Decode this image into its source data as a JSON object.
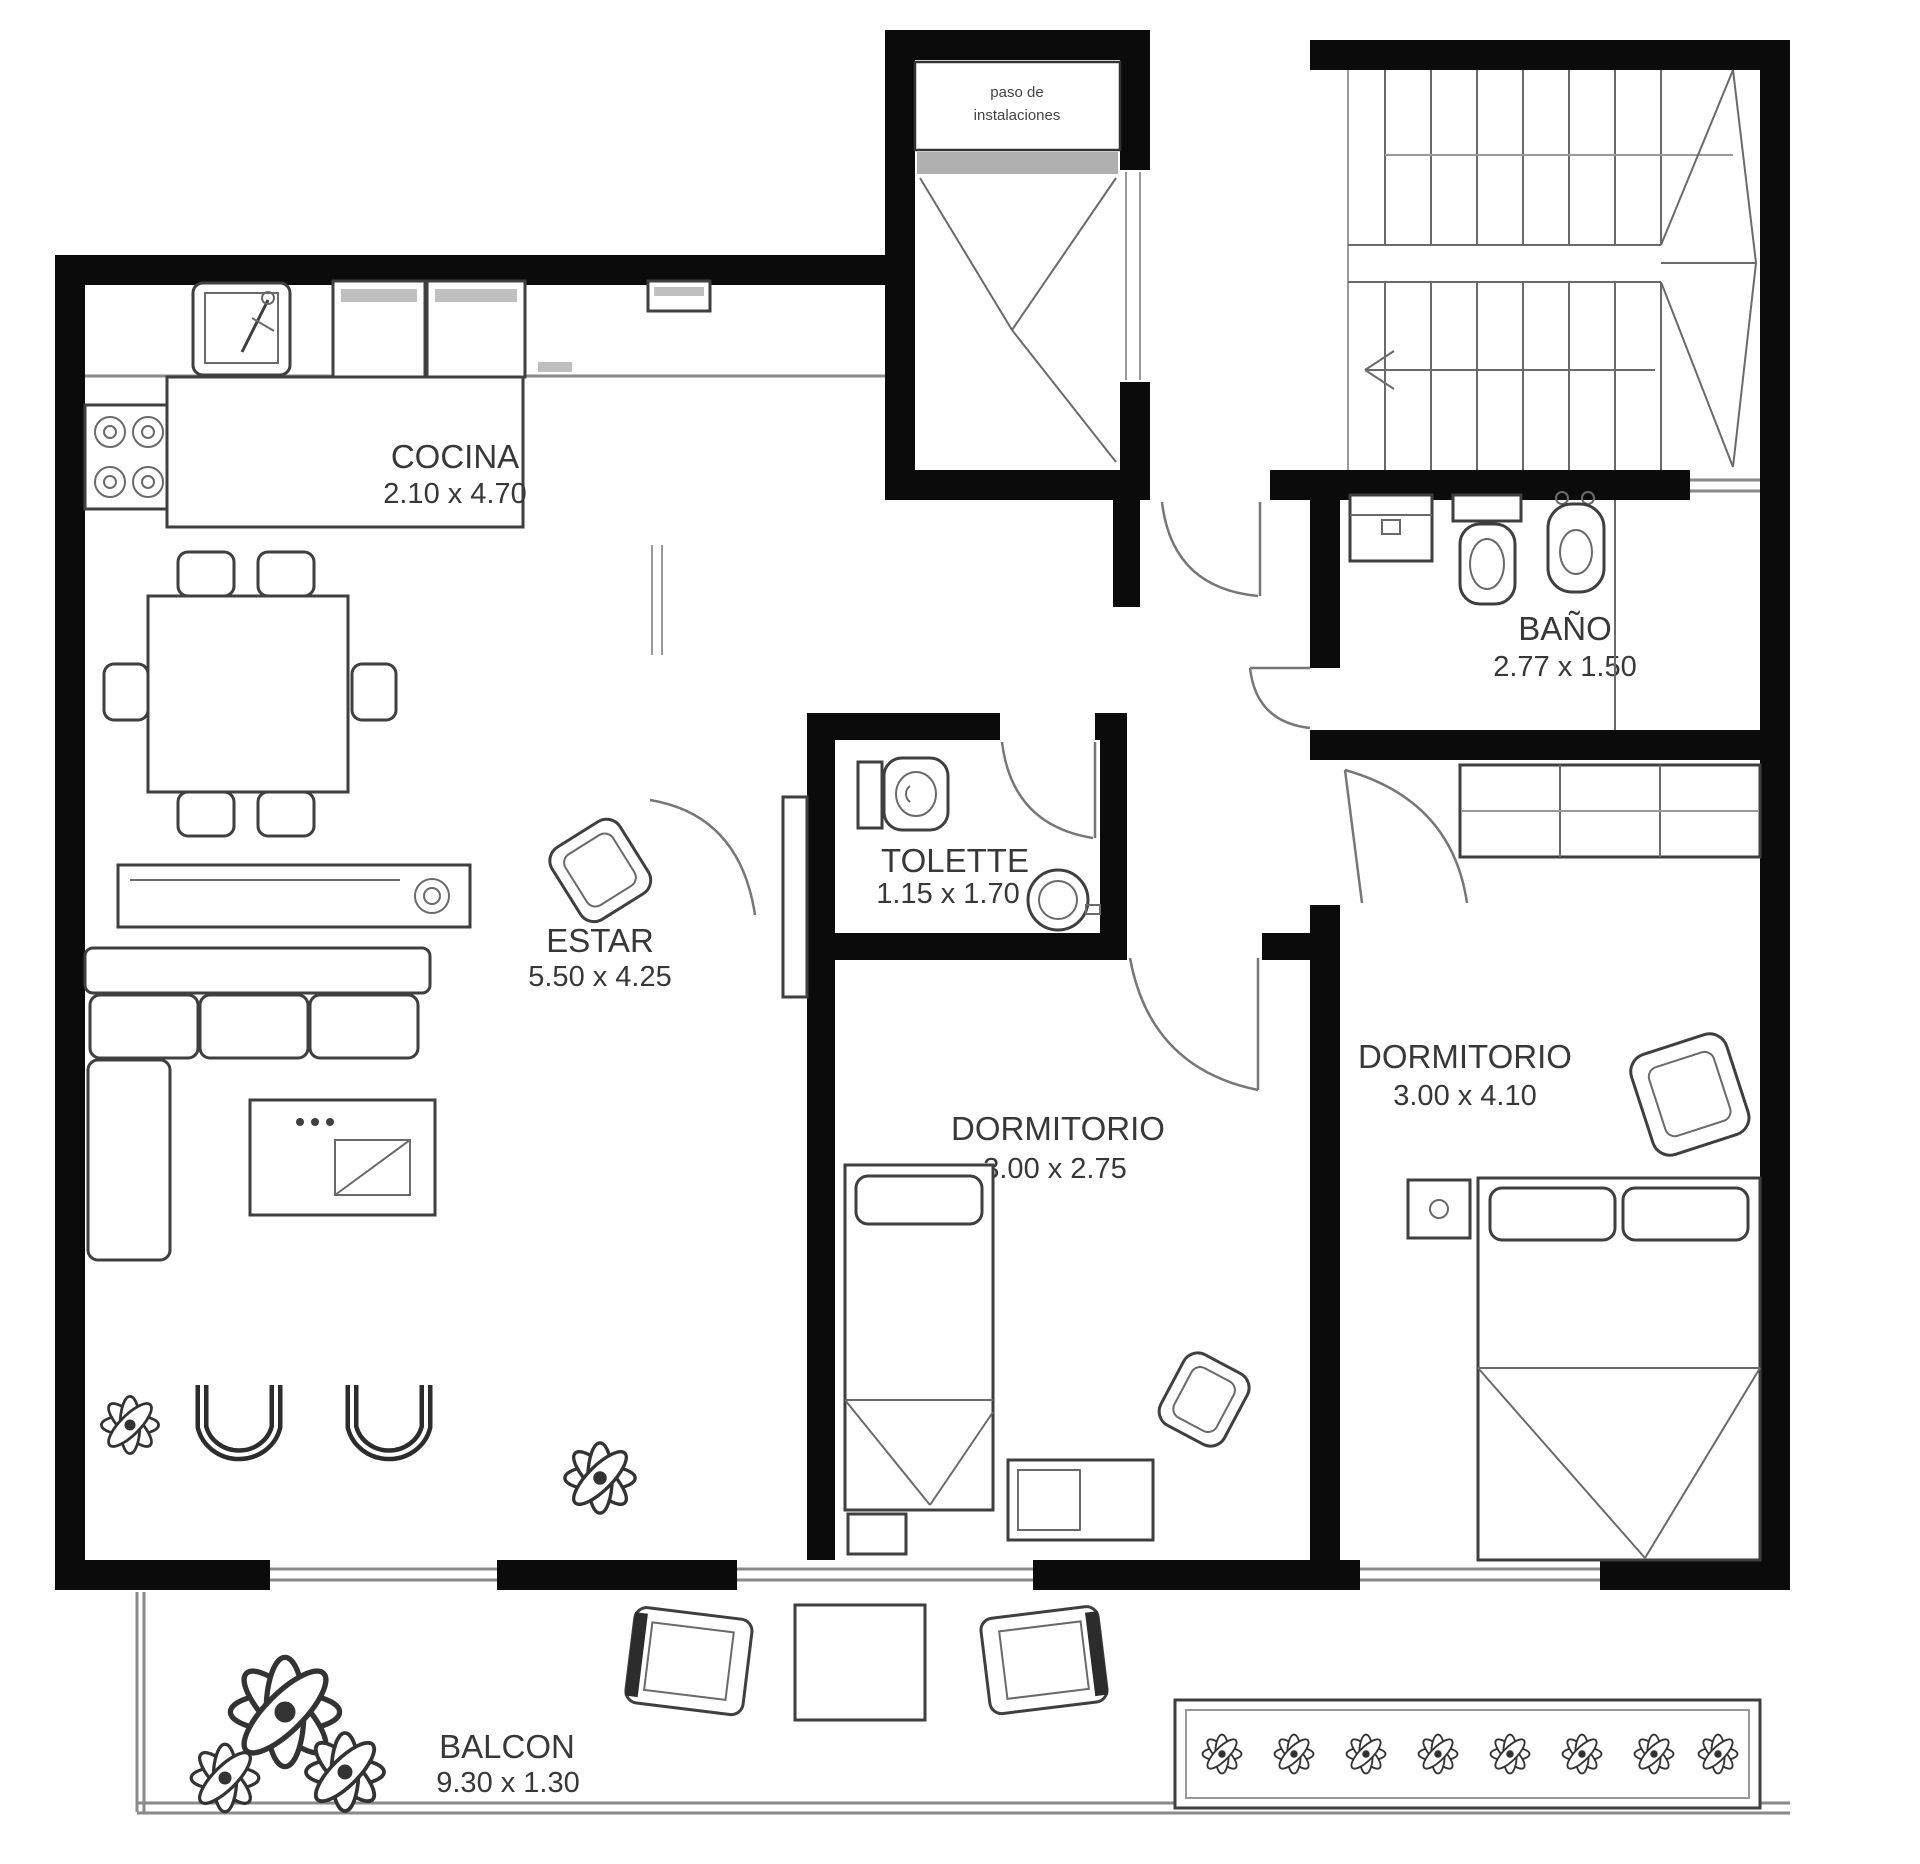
{
  "labels": {
    "cocina": {
      "name": "COCINA",
      "dims": "2.10 x 4.70"
    },
    "estar": {
      "name": "ESTAR",
      "dims": "5.50 x 4.25"
    },
    "toilette": {
      "name": "TOLETTE",
      "dims": "1.15 x 1.70"
    },
    "dormitorio_1": {
      "name": "DORMITORIO",
      "dims": "3.00 x 2.75"
    },
    "dormitorio_2": {
      "name": "DORMITORIO",
      "dims": "3.00 x 4.10"
    },
    "bano": {
      "name": "BAÑO",
      "dims": "2.77 x 1.50"
    },
    "balcon": {
      "name": "BALCON",
      "dims": "9.30 x 1.30"
    },
    "shaft": {
      "line1": "paso de",
      "line2": "instalaciones"
    }
  },
  "colors": {
    "wall": "#0b0b0b",
    "furniture_line": "#3f3f3f",
    "light_line": "#8a8a8a",
    "text": "#383838",
    "paper": "#ffffff"
  }
}
